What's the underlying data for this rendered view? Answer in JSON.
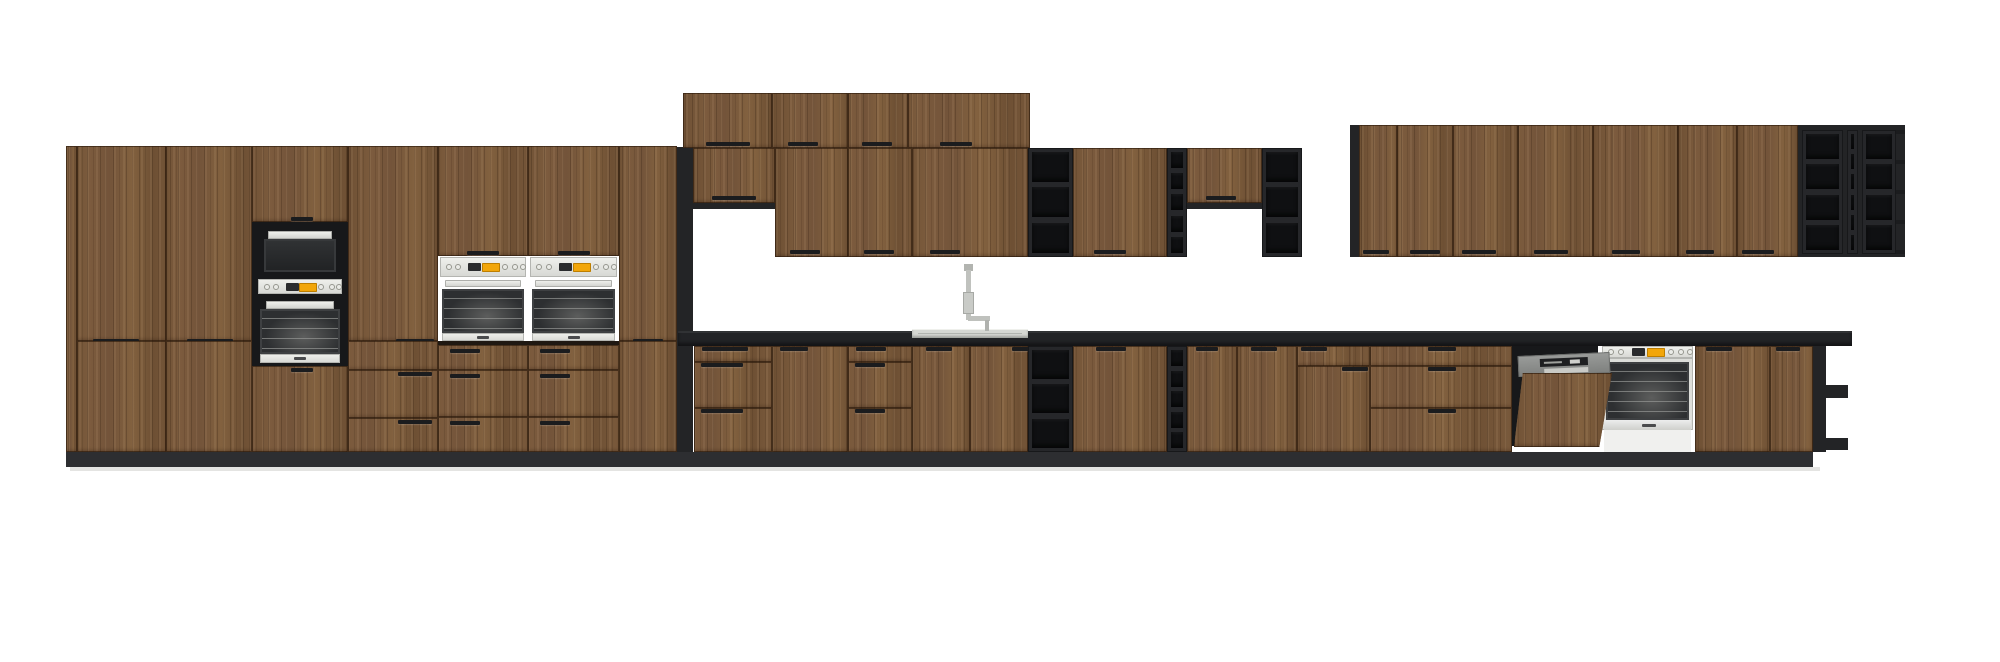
{
  "meta": {
    "description": "kitchen-elevation-render",
    "canvas": {
      "width": 2000,
      "height": 662
    },
    "background": "#ffffff"
  },
  "colors": {
    "wood": "#7a5a3c",
    "dark": "#232426",
    "niche": "#17181a",
    "cell": "#0f1012",
    "counter": "#222326",
    "plinth": "#2d2e31",
    "floor": "#e4e4e2",
    "steel": "#d6d7d3",
    "steel_light": "#eceded",
    "glass": "#2d2f31",
    "display_orange": "#f2a60a",
    "dw_gray": "#8f918f",
    "sink": "#d6d7d3"
  },
  "scene": {
    "modules": [
      {
        "n": "plinth",
        "t": "rect",
        "c": "plinth",
        "x": 66,
        "y": 452,
        "w": 1747,
        "h": 15
      },
      {
        "n": "floor-shadow",
        "t": "rect",
        "c": "floor",
        "x": 70,
        "y": 467,
        "w": 1750,
        "h": 4
      },
      {
        "n": "tall-run-left-filler",
        "t": "wood",
        "x": 66,
        "y": 146,
        "w": 11,
        "h": 306
      },
      {
        "n": "tall-door-a-upper",
        "t": "door",
        "x": 77,
        "y": 146,
        "w": 89,
        "h": 195,
        "hd": [
          {
            "x": 93,
            "y": 339,
            "w": 46
          }
        ]
      },
      {
        "n": "tall-door-a-lower",
        "t": "door",
        "x": 77,
        "y": 341,
        "w": 89,
        "h": 111
      },
      {
        "n": "tall-door-b-upper",
        "t": "door",
        "x": 166,
        "y": 146,
        "w": 86,
        "h": 195,
        "hd": [
          {
            "x": 187,
            "y": 339,
            "w": 46
          }
        ]
      },
      {
        "n": "tall-door-b-lower",
        "t": "door",
        "x": 166,
        "y": 341,
        "w": 86,
        "h": 111
      },
      {
        "n": "oven-microwave-tower",
        "t": "micro-tower",
        "x": 252,
        "y": 146,
        "w": 96,
        "h": 306
      },
      {
        "n": "tall-door-d-upper",
        "t": "door",
        "x": 348,
        "y": 146,
        "w": 90,
        "h": 195,
        "hd": [
          {
            "x": 396,
            "y": 339,
            "w": 38
          }
        ]
      },
      {
        "n": "tall-drawers-d",
        "t": "drawers",
        "x": 348,
        "y": 341,
        "w": 90,
        "h": 111,
        "rows": [
          {
            "y": 341,
            "h": 29
          },
          {
            "y": 370,
            "h": 48
          },
          {
            "y": 418,
            "h": 34
          }
        ],
        "hd": [
          {
            "x": 398,
            "y": 372,
            "w": 34
          },
          {
            "x": 398,
            "y": 420,
            "w": 34
          }
        ]
      },
      {
        "n": "oven-tower-1",
        "t": "oven-tower",
        "x": 438,
        "y": 146,
        "w": 90,
        "h": 306
      },
      {
        "n": "oven-tower-2",
        "t": "oven-tower",
        "x": 528,
        "y": 146,
        "w": 91,
        "h": 306
      },
      {
        "n": "tall-door-g-upper",
        "t": "door",
        "x": 619,
        "y": 146,
        "w": 58,
        "h": 195,
        "hd": [
          {
            "x": 633,
            "y": 339,
            "w": 30
          }
        ]
      },
      {
        "n": "tall-door-g-lower",
        "t": "door",
        "x": 619,
        "y": 341,
        "w": 58,
        "h": 111
      },
      {
        "n": "tall-run-end-panel",
        "t": "rect",
        "c": "dark",
        "x": 677,
        "y": 147,
        "w": 16,
        "h": 305
      },
      {
        "n": "top-cabinet-door-1",
        "t": "door",
        "x": 683,
        "y": 93,
        "w": 89,
        "h": 55,
        "hd": [
          {
            "x": 706,
            "y": 142,
            "w": 44
          }
        ]
      },
      {
        "n": "top-cabinet-door-2",
        "t": "door",
        "x": 772,
        "y": 93,
        "w": 76,
        "h": 55,
        "hd": [
          {
            "x": 788,
            "y": 142,
            "w": 30
          }
        ]
      },
      {
        "n": "top-cabinet-door-3",
        "t": "door",
        "x": 848,
        "y": 93,
        "w": 60,
        "h": 55,
        "hd": [
          {
            "x": 862,
            "y": 142,
            "w": 30
          }
        ]
      },
      {
        "n": "top-cabinet-door-4",
        "t": "door",
        "x": 908,
        "y": 93,
        "w": 122,
        "h": 55,
        "hd": [
          {
            "x": 940,
            "y": 142,
            "w": 32
          }
        ]
      },
      {
        "n": "wall-door-short-1",
        "t": "door",
        "x": 693,
        "y": 148,
        "w": 82,
        "h": 55,
        "hd": [
          {
            "x": 712,
            "y": 196,
            "w": 44
          }
        ]
      },
      {
        "n": "wall-door-short-1-lip",
        "t": "rect",
        "c": "dark",
        "x": 693,
        "y": 203,
        "w": 82,
        "h": 6
      },
      {
        "n": "wall-door-1",
        "t": "door",
        "x": 775,
        "y": 148,
        "w": 73,
        "h": 109,
        "hd": [
          {
            "x": 790,
            "y": 250,
            "w": 30
          }
        ]
      },
      {
        "n": "wall-door-2",
        "t": "door",
        "x": 848,
        "y": 148,
        "w": 64,
        "h": 109,
        "hd": [
          {
            "x": 864,
            "y": 250,
            "w": 30
          }
        ]
      },
      {
        "n": "wall-door-wide",
        "t": "door",
        "x": 912,
        "y": 148,
        "w": 116,
        "h": 109,
        "hd": [
          {
            "x": 930,
            "y": 250,
            "w": 30
          }
        ]
      },
      {
        "n": "wall-open-shelf-1",
        "t": "shelves",
        "x": 1028,
        "y": 148,
        "w": 45,
        "h": 109,
        "rows": 3
      },
      {
        "n": "wall-door-3",
        "t": "door",
        "x": 1073,
        "y": 148,
        "w": 94,
        "h": 109,
        "hd": [
          {
            "x": 1094,
            "y": 250,
            "w": 32
          }
        ]
      },
      {
        "n": "wall-open-shelf-narrow",
        "t": "shelves",
        "x": 1167,
        "y": 148,
        "w": 20,
        "h": 109,
        "rows": 5
      },
      {
        "n": "wall-door-short-2",
        "t": "door",
        "x": 1187,
        "y": 148,
        "w": 75,
        "h": 55,
        "hd": [
          {
            "x": 1206,
            "y": 196,
            "w": 30
          }
        ]
      },
      {
        "n": "wall-door-short-2-lip",
        "t": "rect",
        "c": "dark",
        "x": 1187,
        "y": 203,
        "w": 75,
        "h": 6
      },
      {
        "n": "wall-open-shelf-2",
        "t": "shelves",
        "x": 1262,
        "y": 148,
        "w": 40,
        "h": 109,
        "rows": 3
      },
      {
        "n": "right-wall-edge",
        "t": "rect",
        "c": "dark",
        "x": 1350,
        "y": 125,
        "w": 9,
        "h": 132
      },
      {
        "n": "right-wall-door-1",
        "t": "door",
        "x": 1359,
        "y": 125,
        "w": 38,
        "h": 132,
        "hd": [
          {
            "x": 1363,
            "y": 250,
            "w": 26
          }
        ]
      },
      {
        "n": "right-wall-door-2",
        "t": "door",
        "x": 1397,
        "y": 125,
        "w": 56,
        "h": 132,
        "hd": [
          {
            "x": 1410,
            "y": 250,
            "w": 30
          }
        ]
      },
      {
        "n": "right-wall-door-3",
        "t": "door",
        "x": 1453,
        "y": 125,
        "w": 65,
        "h": 132,
        "hd": [
          {
            "x": 1462,
            "y": 250,
            "w": 34
          }
        ]
      },
      {
        "n": "right-wall-door-4",
        "t": "door",
        "x": 1518,
        "y": 125,
        "w": 75,
        "h": 132,
        "hd": [
          {
            "x": 1534,
            "y": 250,
            "w": 34
          }
        ]
      },
      {
        "n": "right-wall-door-5",
        "t": "door",
        "x": 1593,
        "y": 125,
        "w": 85,
        "h": 132,
        "hd": [
          {
            "x": 1612,
            "y": 250,
            "w": 28
          }
        ]
      },
      {
        "n": "right-wall-door-6",
        "t": "door",
        "x": 1678,
        "y": 125,
        "w": 59,
        "h": 132,
        "hd": [
          {
            "x": 1686,
            "y": 250,
            "w": 28
          }
        ]
      },
      {
        "n": "right-wall-door-7",
        "t": "door",
        "x": 1737,
        "y": 125,
        "w": 61,
        "h": 132,
        "hd": [
          {
            "x": 1742,
            "y": 250,
            "w": 32
          }
        ]
      },
      {
        "n": "right-wall-cubby-frame",
        "t": "rect",
        "c": "dark",
        "x": 1798,
        "y": 125,
        "w": 107,
        "h": 132
      },
      {
        "n": "right-wall-cubby-col-1",
        "t": "shelves",
        "x": 1802,
        "y": 130,
        "w": 41,
        "h": 124,
        "rows": 4
      },
      {
        "n": "right-wall-cubby-col-2",
        "t": "shelves",
        "x": 1847,
        "y": 130,
        "w": 11,
        "h": 124,
        "rows": 6
      },
      {
        "n": "right-wall-cubby-col-3",
        "t": "shelves",
        "x": 1862,
        "y": 130,
        "w": 34,
        "h": 124,
        "rows": 4
      },
      {
        "n": "right-wall-cubby-tips",
        "t": "tips",
        "x": 1896,
        "y": 130,
        "w": 9,
        "h": 124,
        "rows": 4
      },
      {
        "n": "countertop",
        "t": "counter",
        "x": 678,
        "y": 331,
        "w": 1174,
        "h": 15
      },
      {
        "n": "sink",
        "t": "sink",
        "x": 912,
        "y": 329,
        "w": 116,
        "h": 9
      },
      {
        "n": "faucet",
        "t": "faucet",
        "x": 960,
        "y": 264,
        "w": 30,
        "h": 67
      },
      {
        "n": "base-drawers-1",
        "t": "drawers",
        "x": 694,
        "y": 346,
        "w": 78,
        "h": 106,
        "rows": [
          {
            "y": 346,
            "h": 16
          },
          {
            "y": 362,
            "h": 46
          },
          {
            "y": 408,
            "h": 44
          }
        ],
        "hd": [
          {
            "x": 702,
            "y": 347,
            "w": 46
          },
          {
            "x": 701,
            "y": 363,
            "w": 42
          },
          {
            "x": 701,
            "y": 409,
            "w": 42
          }
        ]
      },
      {
        "n": "base-door-1",
        "t": "door",
        "x": 772,
        "y": 346,
        "w": 76,
        "h": 106,
        "hd": [
          {
            "x": 780,
            "y": 347,
            "w": 28
          }
        ]
      },
      {
        "n": "base-drawers-2",
        "t": "drawers",
        "x": 848,
        "y": 346,
        "w": 64,
        "h": 106,
        "rows": [
          {
            "y": 346,
            "h": 16
          },
          {
            "y": 362,
            "h": 46
          },
          {
            "y": 408,
            "h": 44
          }
        ],
        "hd": [
          {
            "x": 856,
            "y": 347,
            "w": 30
          },
          {
            "x": 855,
            "y": 363,
            "w": 30
          },
          {
            "x": 855,
            "y": 409,
            "w": 30
          }
        ]
      },
      {
        "n": "sink-base-door-left",
        "t": "door",
        "x": 912,
        "y": 346,
        "w": 58,
        "h": 106,
        "hd": [
          {
            "x": 926,
            "y": 347,
            "w": 26
          }
        ]
      },
      {
        "n": "sink-base-door-right",
        "t": "door",
        "x": 970,
        "y": 346,
        "w": 58,
        "h": 106,
        "hd": [
          {
            "x": 1012,
            "y": 347,
            "w": 26
          }
        ]
      },
      {
        "n": "base-open-shelf-1",
        "t": "shelves",
        "x": 1028,
        "y": 346,
        "w": 45,
        "h": 106,
        "rows": 3
      },
      {
        "n": "base-door-2",
        "t": "door",
        "x": 1073,
        "y": 346,
        "w": 94,
        "h": 106,
        "hd": [
          {
            "x": 1096,
            "y": 347,
            "w": 30
          }
        ]
      },
      {
        "n": "base-open-shelf-narrow",
        "t": "shelves",
        "x": 1167,
        "y": 346,
        "w": 20,
        "h": 106,
        "rows": 5
      },
      {
        "n": "base-door-3",
        "t": "door",
        "x": 1187,
        "y": 346,
        "w": 50,
        "h": 106,
        "hd": [
          {
            "x": 1196,
            "y": 347,
            "w": 22
          }
        ]
      },
      {
        "n": "base-door-4",
        "t": "door",
        "x": 1237,
        "y": 346,
        "w": 60,
        "h": 106,
        "hd": [
          {
            "x": 1251,
            "y": 347,
            "w": 26
          }
        ]
      },
      {
        "n": "base-combo-drawer",
        "t": "drawers",
        "x": 1297,
        "y": 346,
        "w": 73,
        "h": 20,
        "rows": [
          {
            "y": 346,
            "h": 20
          }
        ],
        "hd": [
          {
            "x": 1301,
            "y": 347,
            "w": 26
          }
        ]
      },
      {
        "n": "base-combo-door",
        "t": "door",
        "x": 1297,
        "y": 366,
        "w": 73,
        "h": 86,
        "hd": [
          {
            "x": 1342,
            "y": 367,
            "w": 26
          }
        ]
      },
      {
        "n": "base-drawers-3",
        "t": "drawers",
        "x": 1370,
        "y": 346,
        "w": 142,
        "h": 106,
        "rows": [
          {
            "y": 346,
            "h": 20
          },
          {
            "y": 366,
            "h": 42
          },
          {
            "y": 408,
            "h": 44
          }
        ],
        "hd": [
          {
            "x": 1428,
            "y": 347,
            "w": 28
          },
          {
            "x": 1428,
            "y": 367,
            "w": 28
          },
          {
            "x": 1428,
            "y": 409,
            "w": 28
          }
        ]
      },
      {
        "n": "dishwasher-niche",
        "t": "rect",
        "c": "niche",
        "x": 1512,
        "y": 346,
        "w": 86,
        "h": 28
      },
      {
        "n": "dishwasher-interior",
        "t": "rect",
        "c": "niche",
        "x": 1512,
        "y": 374,
        "w": 14,
        "h": 72
      },
      {
        "n": "built-in-oven",
        "t": "oven-base",
        "x": 1602,
        "y": 346,
        "w": 91,
        "h": 106
      },
      {
        "n": "dishwasher-door",
        "t": "dw-door",
        "x": 1514,
        "y": 352,
        "w": 100,
        "h": 95
      },
      {
        "n": "base-door-5",
        "t": "door",
        "x": 1695,
        "y": 346,
        "w": 75,
        "h": 106,
        "hd": [
          {
            "x": 1706,
            "y": 347,
            "w": 26
          }
        ]
      },
      {
        "n": "base-door-6",
        "t": "door",
        "x": 1770,
        "y": 346,
        "w": 43,
        "h": 106,
        "hd": [
          {
            "x": 1776,
            "y": 347,
            "w": 24
          }
        ]
      },
      {
        "n": "end-shelf-side-panel",
        "t": "rect",
        "c": "dark",
        "x": 1813,
        "y": 346,
        "w": 13,
        "h": 106
      },
      {
        "n": "end-shelf-board-1",
        "t": "rect",
        "c": "dark",
        "x": 1826,
        "y": 385,
        "w": 22,
        "h": 13
      },
      {
        "n": "end-shelf-board-2",
        "t": "rect",
        "c": "dark",
        "x": 1826,
        "y": 438,
        "w": 22,
        "h": 12
      }
    ]
  }
}
